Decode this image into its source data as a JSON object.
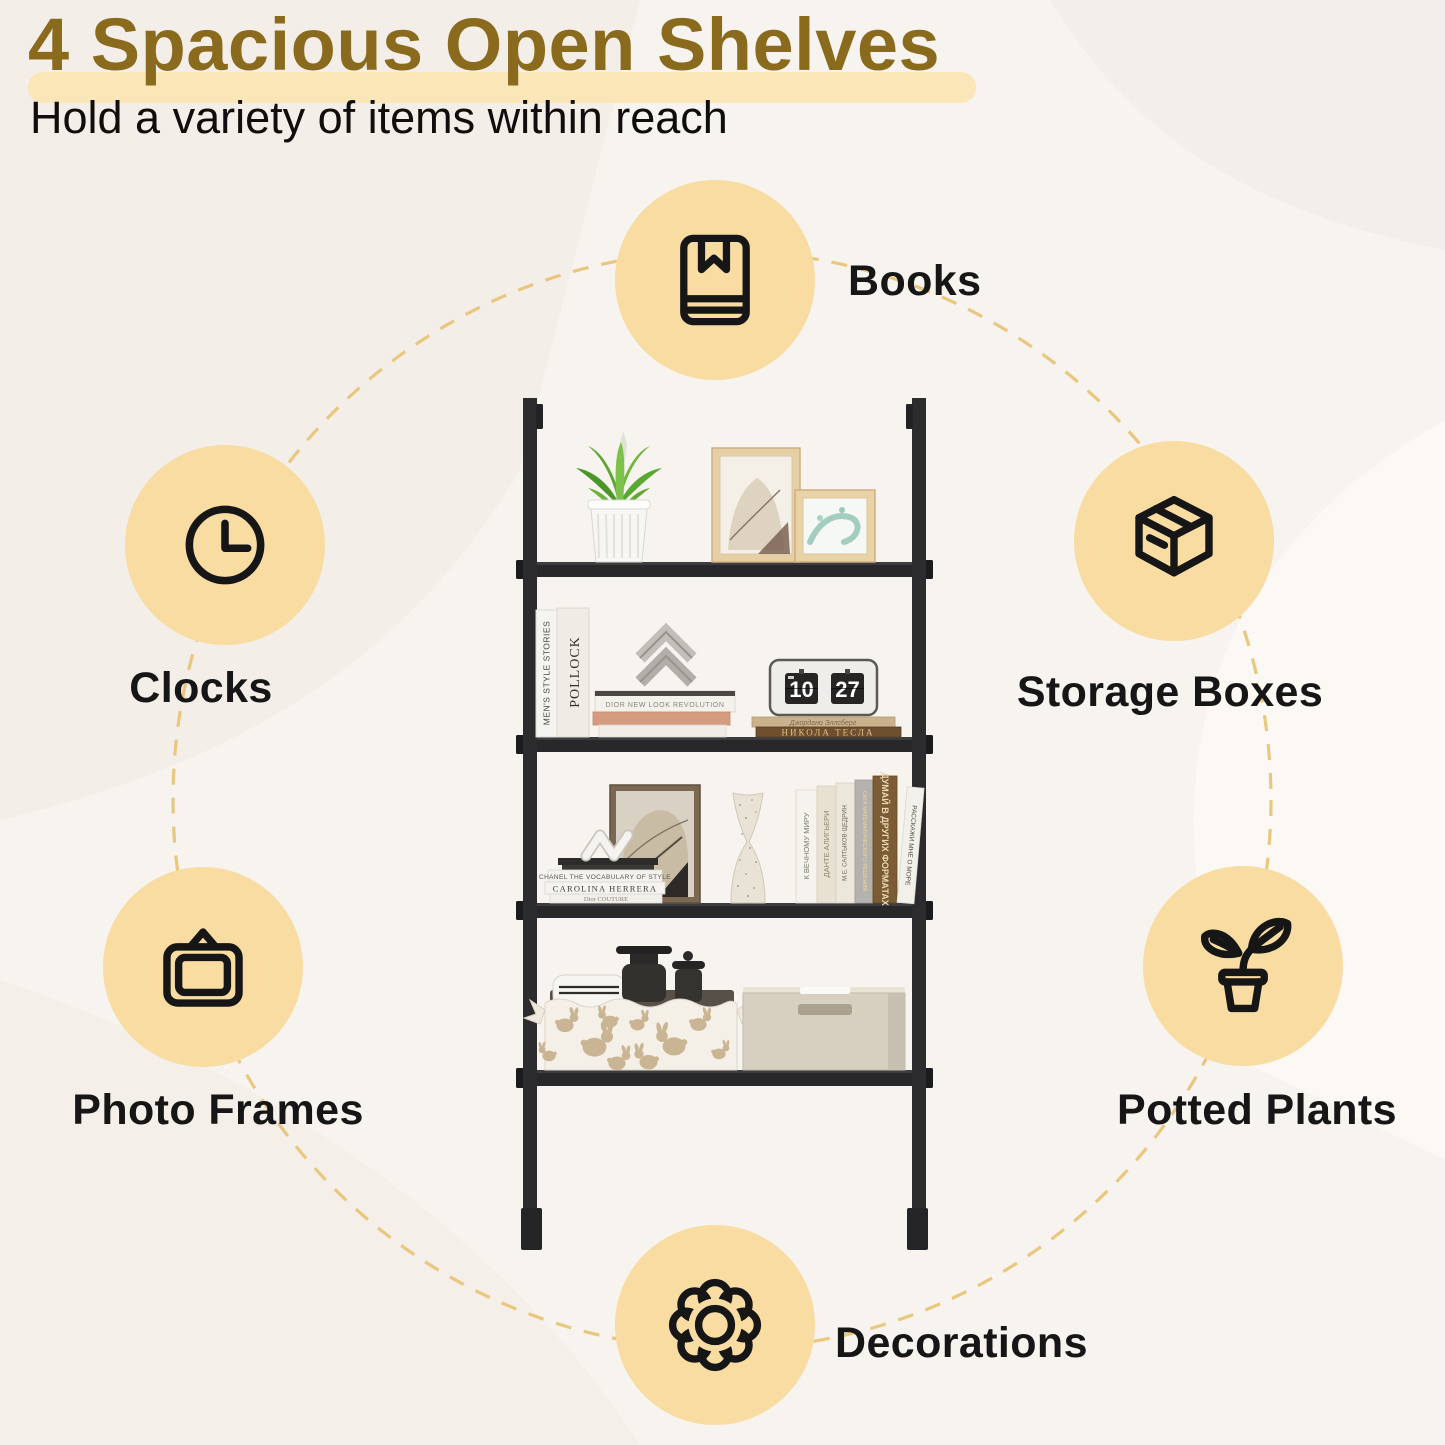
{
  "header": {
    "title": "4 Spacious Open Shelves",
    "subtitle": "Hold a variety of items within reach"
  },
  "features": [
    {
      "id": "books",
      "label": "Books",
      "icon": "book-icon"
    },
    {
      "id": "clocks",
      "label": "Clocks",
      "icon": "clock-icon"
    },
    {
      "id": "storage-boxes",
      "label": "Storage Boxes",
      "icon": "box-icon"
    },
    {
      "id": "photo-frames",
      "label": "Photo Frames",
      "icon": "picture-frame-icon"
    },
    {
      "id": "potted-plants",
      "label": "Potted Plants",
      "icon": "potted-plant-icon"
    },
    {
      "id": "decorations",
      "label": "Decorations",
      "icon": "flower-icon"
    }
  ],
  "shelf": {
    "upright_books_tier2": [
      "MEN'S STYLE STORIES",
      "POLLOCK"
    ],
    "stacked_book_tier2": "DIOR  NEW LOOK REVOLUTION",
    "flip_clock": {
      "hour": "10",
      "minute": "27"
    },
    "flat_books_tier2": [
      "Джордано Эллсберг",
      "НИКОЛА ТЕСЛА"
    ],
    "stacked_books_tier3": [
      "CHANEL  THE VOCABULARY OF STYLE",
      "CAROLINA HERRERA",
      "Dior  COUTURE"
    ],
    "spine_books_tier3": [
      "К ВЕЧНОМУ МИРУ",
      "ДАНТЕ АЛИГЬЕРИ",
      "М.Е. САЛТЫКОВ-ЩЕДРИН",
      "САГА МАТЕМАТИЧЕСКОГО РЕШЕНИЯ",
      "ДУМАЙ В ДРУГИХ ФОРМАТАХ",
      "РАССКАЖИ МНЕ О МОРЕ"
    ]
  },
  "colors": {
    "background": "#f7f3ee",
    "title_text": "#8a6a1c",
    "title_highlight": "#fae6b6",
    "feature_circle": "#f8dca2",
    "dashed_ring": "#eac77e",
    "label_text": "#161616",
    "shelf_frame": "#2a2a2c"
  }
}
